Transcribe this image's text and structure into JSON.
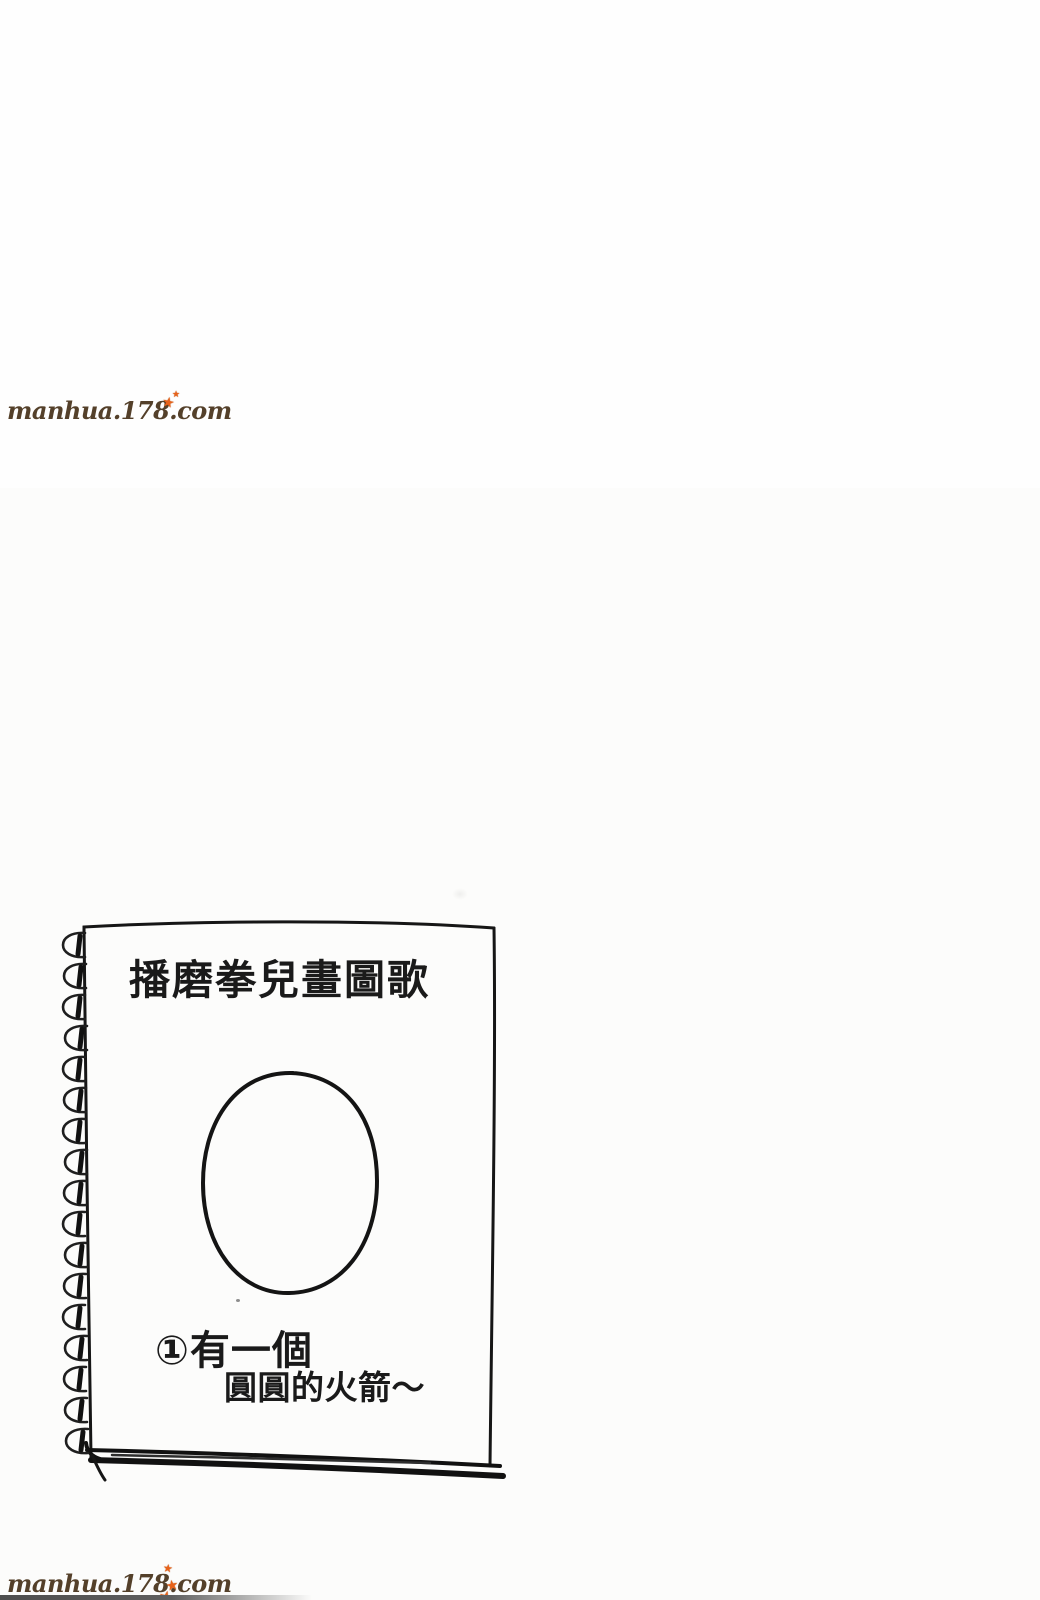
{
  "page": {
    "background_color": "#fefefe",
    "ink_color": "#1a1a1a"
  },
  "watermarks": {
    "color": "#54402a",
    "star_color": "#e8621a",
    "star_glyph": "★",
    "top": {
      "text": "manhua.178.com"
    },
    "bottom": {
      "text": "manhua.178.com"
    }
  },
  "notebook": {
    "title": "播磨拳兒畫圖歌",
    "caption": {
      "line1": "①有一個",
      "line2": "圓圓的火箭～"
    }
  }
}
